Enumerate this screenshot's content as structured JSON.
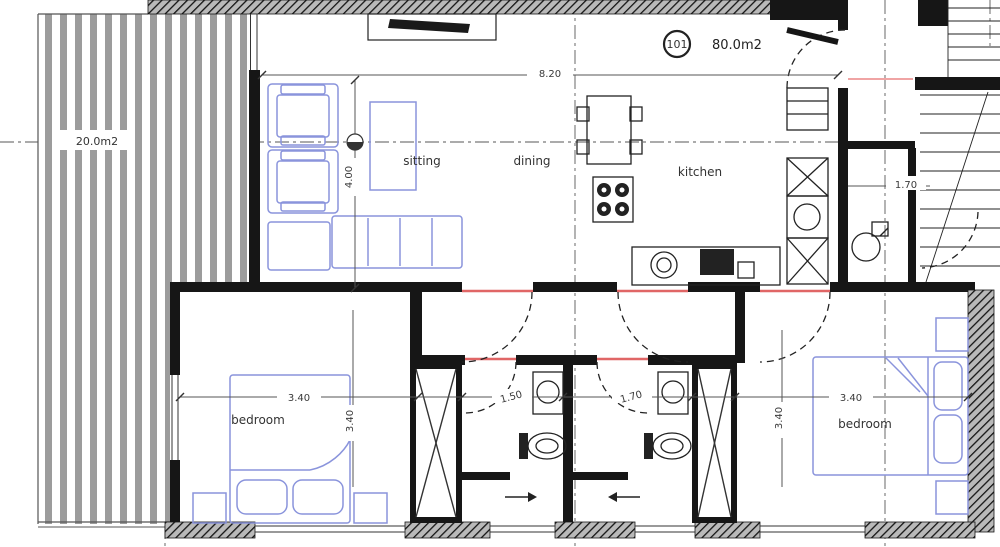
{
  "unit": {
    "number": "101",
    "area_label": "80.0m2"
  },
  "balcony": {
    "area_label": "20.0m2"
  },
  "rooms": {
    "sitting": "sitting",
    "dining": "dining",
    "kitchen": "kitchen",
    "bedroom_left": "bedroom",
    "bedroom_right": "bedroom"
  },
  "dimensions": {
    "overall_width": "8.20",
    "living_depth": "4.00",
    "bedroom_left_width": "3.40",
    "bedroom_left_depth": "3.40",
    "bath_left_width": "1.50",
    "bath_right_width": "1.70",
    "bedroom_right_width": "3.40",
    "bedroom_right_depth": "3.40",
    "wc_right_width": "1.70"
  },
  "colors": {
    "wall": "#161616",
    "furniture_blue": "#8a94dc",
    "door_red": "#e06666",
    "dimension_gray": "#555555"
  }
}
